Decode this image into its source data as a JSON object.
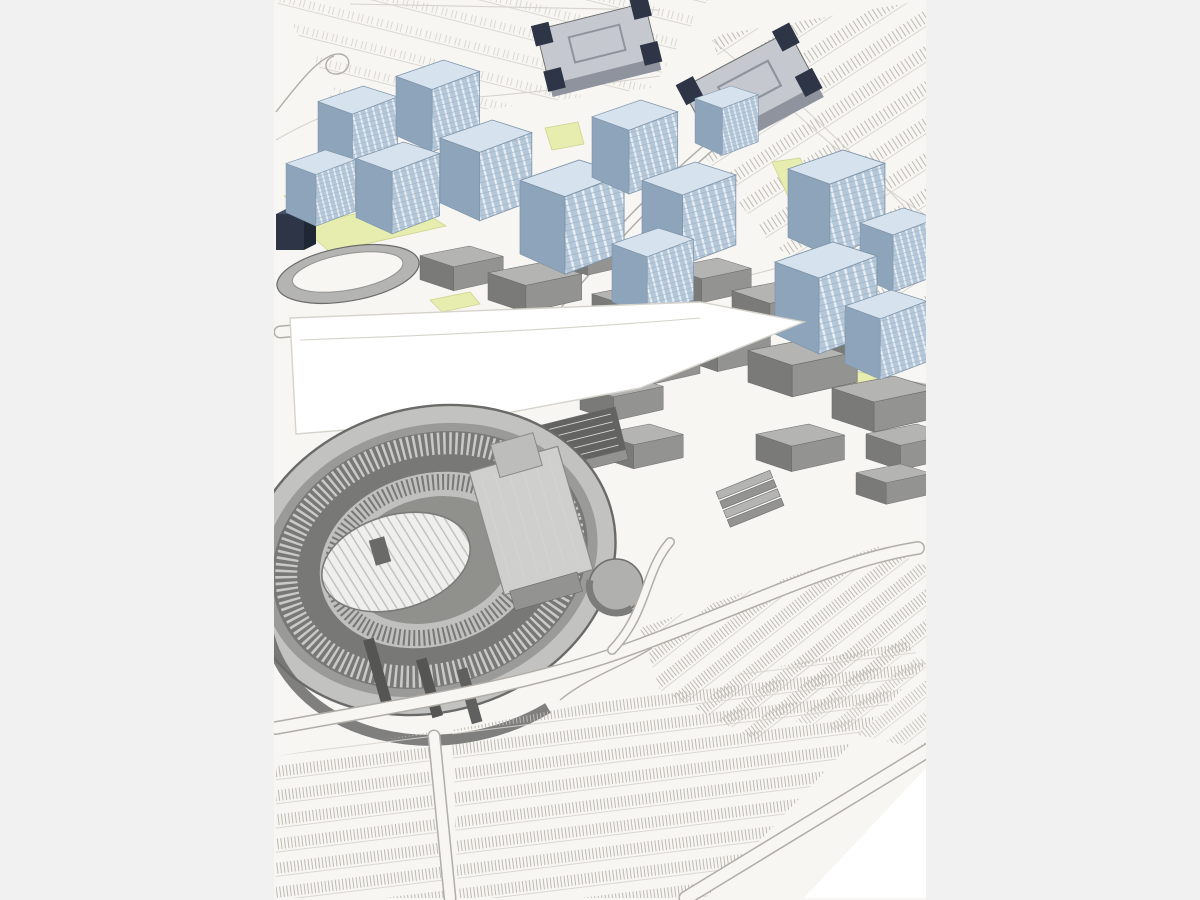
{
  "meta": {
    "kind": "letterboxed-photo-viewer",
    "description": "Aerial pencil-and-wash architectural rendering of a proposed stadium district: an oval stadium at lower left, a grey mixed-use massing district across the middle, light-blue residential towers to the north, yellow-green lawn panels, and large hatched surface parking fields at the top and bottom."
  },
  "layout": {
    "image_left_px": 274,
    "image_right_px": 926,
    "image_width_px": 652,
    "image_height_px": 900
  },
  "colors": {
    "sidebar": "#f1f1f2",
    "paper": "#f7f6f3",
    "white": "#ffffff",
    "line_faint": "#d6d3cc",
    "line_med": "#b1aea8",
    "lawn": "#e7edae",
    "lawn_edge": "#ccd68e",
    "tower_face": "#b5c8d9",
    "tower_gap": "#e9eff5",
    "tower_hline": "#9db2c5",
    "tower_side": "#8da4ba",
    "tower_roof": "#d6e3ee",
    "tower_edge": "#7e94a9",
    "navy": "#2d3546",
    "navy_light": "#465064",
    "steel_top": "#c5c9cf",
    "steel_front": "#8e939d",
    "blk_top": "#b4b4b2",
    "blk_front": "#939391",
    "blk_side": "#7a7a78",
    "blk_edge": "#6b6b69",
    "blk_darkroof": "#636361",
    "stad_outer": "#c2c2c0",
    "stad_ring": "#9a9a98",
    "stad_deck": "#c9c9c7",
    "stad_mid": "#787876",
    "stad_light": "#c0c0be",
    "stad_bowl": "#90908c",
    "stad_dark": "#6a6a68",
    "field_base": "#efefec",
    "field_line": "#bcbcba",
    "pk_mark": "#bdbab2",
    "pk_faint": "#d8d5ce"
  },
  "regions": {
    "letterbox_left": "Light grey letterbox bar, left side",
    "letterbox_right": "Light grey letterbox bar, right side",
    "canvas": "Aerial rendering of stadium redevelopment master plan",
    "parking_nw": "Faint striped surface parking lot, upper left",
    "parking_ne": "Diagonal striped surface parking lot, upper right",
    "towers": "Cluster of light blue mid-rise residential towers with hatched window facades",
    "office_north": "Grey office building with dark navy corner cores, top center",
    "office_ne": "Grey office building with dark navy corner cores, upper right",
    "navy_building": "Small dark navy building at left edge",
    "lawns": "Yellow-green lawn and planting panels",
    "streets": "Curving access streets between development parcels",
    "district": "Grey massing blocks of the mixed-use entertainment district",
    "pavilion": "Oval event pavilion north of the stadium",
    "plaza": "White open plaza and practice field between towers and stadium",
    "stadium": "Large oval stadium bowl with concentric seating tiers",
    "stadium_field": "Striped playing field inside the stadium bowl",
    "stage": "Stage-house structures at the east end of the bowl",
    "drum": "Round drum-shaped pavilion east of the stadium",
    "parking_s": "Large fan of striped parking rows across the bottom",
    "parking_se": "Diagonal parking rows and loop roads, lower right",
    "wedge": "Blank white wedge at the bottom right corner",
    "loop_sketch": "Loose sketched loop road, upper left"
  }
}
